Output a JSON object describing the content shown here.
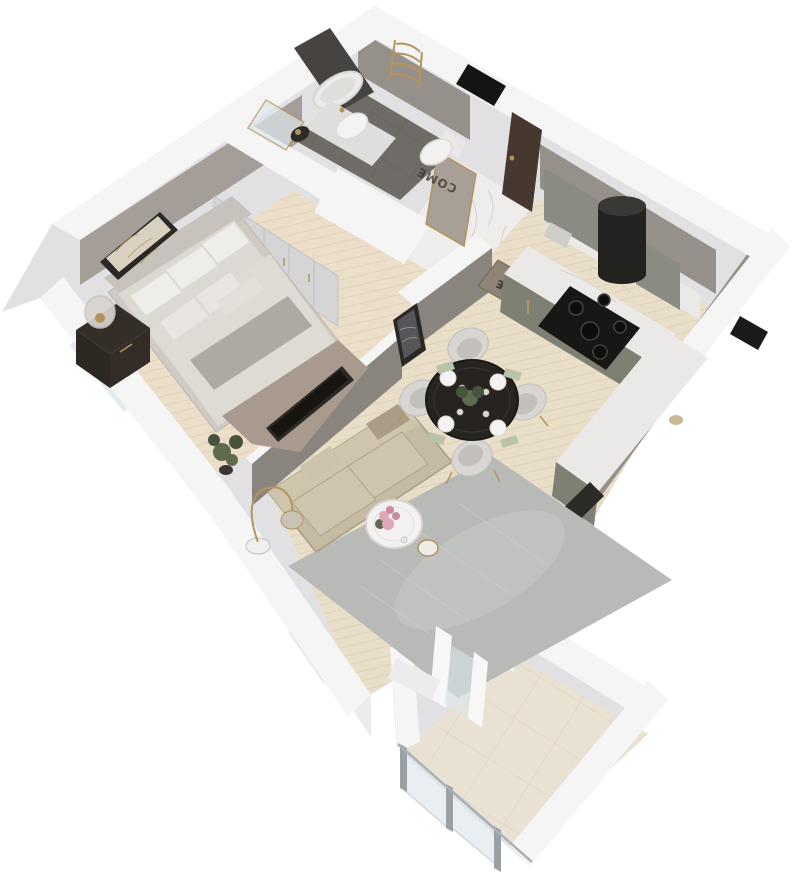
{
  "canvas": {
    "width": 800,
    "height": 893,
    "background": "#ffffff"
  },
  "labels": {
    "welcome_mat_word": "WELCOME",
    "mat_fragment_mirror": "COME",
    "mat_fragment_floor": "ME"
  },
  "colors": {
    "bg": "#ffffff",
    "wall_top": "#f5f5f6",
    "wall_outer": "#e1e1e4",
    "soft_edge": "#d3d3d7",
    "face_greige": "#a59d97",
    "face_gray": "#95908a",
    "face_dark": "#8a847e",
    "parquet": "#e9dec8",
    "parquet_bed": "#ecdfca",
    "parquet_line": "#d7c8aa",
    "marble": "#efedeb",
    "marble_vein": "#d1cecb",
    "bath_floor": "#6f6b67",
    "bath_line": "#5f5b58",
    "balcony_tile": "#e9e1d2",
    "balcony_line": "#d8cfbe",
    "glass": "#dce6ea",
    "glass_frame": "#a9b1b5",
    "rug": "#b7bab6",
    "rug_light": "#c9ccc7",
    "sofa": "#c5bba3",
    "sofa_light": "#cfc5ad",
    "sofa_dark": "#a89d85",
    "bed": "#dcd8d2",
    "bed_sheet": "#cfcac3",
    "bed_throw": "#aaa39d",
    "bed_blanket": "#a89a8f",
    "pillow": "#efede9",
    "headboard": "#c7c2bc",
    "table_dark": "#262321",
    "chair": "#d8d6d3",
    "chair_seat": "#c3c0bc",
    "cabinet": "#7e8074",
    "cabinet_upper": "#8a8c83",
    "counter": "#ebe9e7",
    "hob": "#181715",
    "hood": "#242220",
    "gold": "#b3945c",
    "door": "#46382f",
    "dark_unit": "#2c2a27",
    "niche": "#141415",
    "window_dark": "#1b1b1d",
    "mirror": "#a8a096",
    "mat": "#8e8578",
    "mat_text": "#3a352d",
    "art_frame": "#2a2825",
    "art_bg": "#d8d1c2",
    "art_marble": "#55565a",
    "plant": "#5e6b4e",
    "plant_dark": "#48533b",
    "pot": "#3a3531",
    "flower": "#e0a6b6",
    "flower_dark": "#c98ba0",
    "nightstand": "#342d28",
    "lamp_glass": "#d8d5d0",
    "white": "#f7f7f8",
    "sill": "#ececee"
  }
}
